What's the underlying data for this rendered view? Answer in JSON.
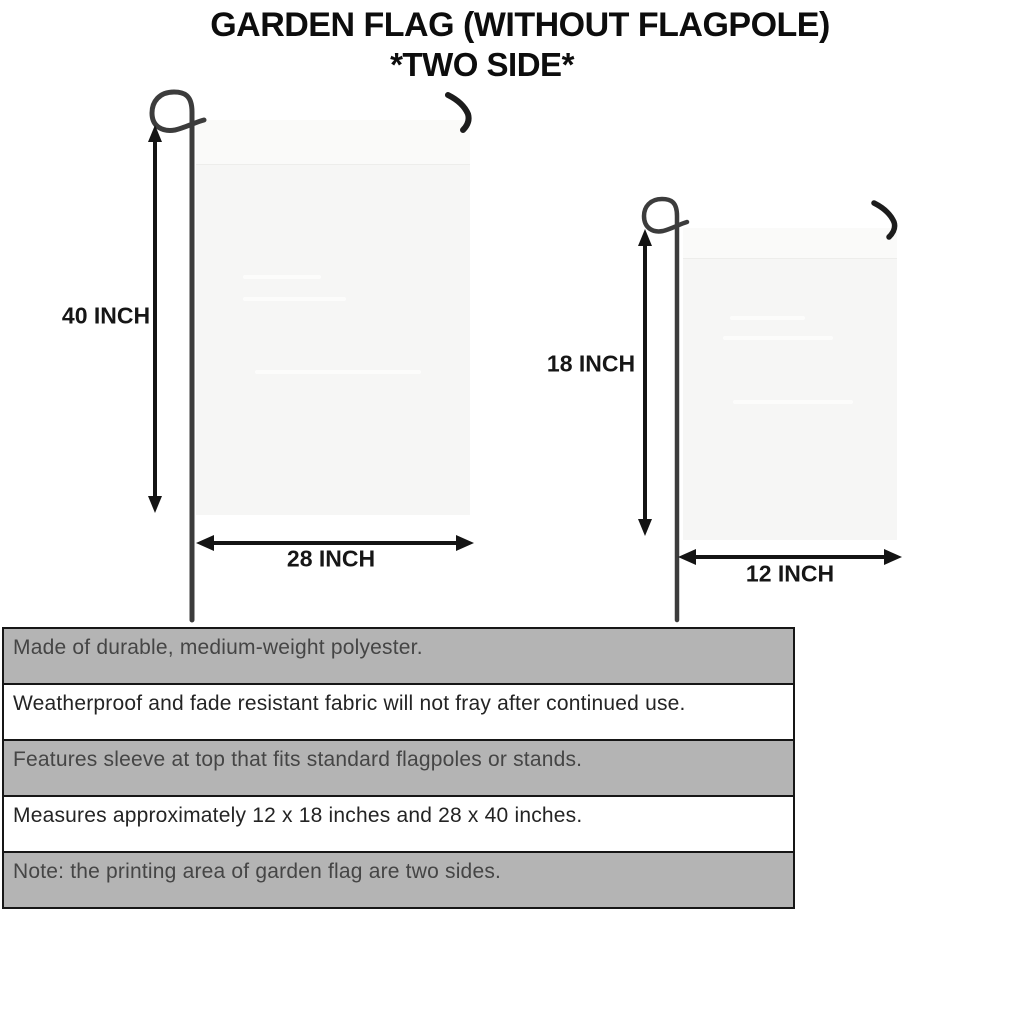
{
  "title": {
    "line1": "GARDEN FLAG (WITHOUT FLAGPOLE)",
    "line2": "*TWO SIDE*"
  },
  "flags": {
    "large": {
      "height_label": "40 INCH",
      "width_label": "28 INCH"
    },
    "small": {
      "height_label": "18 INCH",
      "width_label": "12 INCH"
    }
  },
  "features": [
    {
      "text": "Made of durable, medium-weight polyester.",
      "shaded": true
    },
    {
      "text": "Weatherproof and fade resistant fabric will not fray after continued use.",
      "shaded": false
    },
    {
      "text": "Features sleeve at top that fits standard flagpoles or stands.",
      "shaded": true
    },
    {
      "text": "Measures approximately 12 x 18 inches and 28 x 40 inches.",
      "shaded": false
    },
    {
      "text": "Note: the printing area of garden flag are two sides.",
      "shaded": true
    }
  ],
  "colors": {
    "stripe_gray": "#b4b4b4",
    "stripe_border": "#161616",
    "flag_fill": "#f6f6f5",
    "pole_dark": "#3c3c3c",
    "arrow_black": "#141414",
    "title_black": "#0d0d0d"
  }
}
